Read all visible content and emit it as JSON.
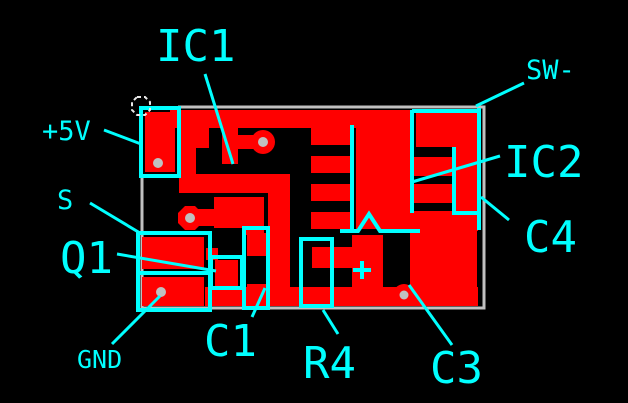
{
  "figure_type": "pcb-copper-layout",
  "colors": {
    "background": "#000000",
    "copper": "#ff0000",
    "silkscreen": "#00ffff",
    "board_edge": "#c0c0c0",
    "drill_hole": "#c0c0c0",
    "selection_marker": "#e8e8e8"
  },
  "labels": {
    "plus5v": {
      "text": "+5V"
    },
    "s": {
      "text": "S"
    },
    "q1": {
      "text": "Q1"
    },
    "gnd": {
      "text": "GND"
    },
    "ic1": {
      "text": "IC1"
    },
    "c1": {
      "text": "C1"
    },
    "r4": {
      "text": "R4"
    },
    "c3": {
      "text": "C3"
    },
    "c4": {
      "text": "C4"
    },
    "ic2": {
      "text": "IC2"
    },
    "sw": {
      "text": "SW-"
    }
  }
}
